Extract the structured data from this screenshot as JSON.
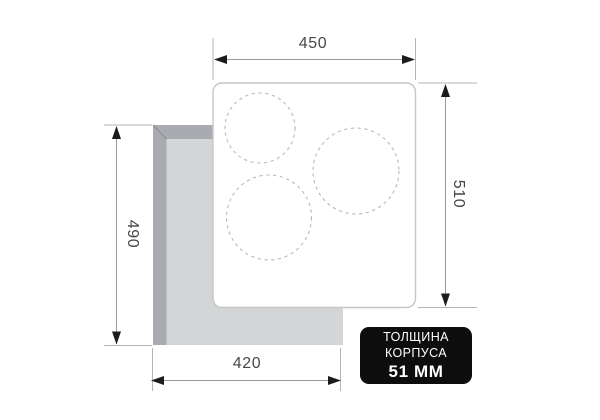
{
  "diagram": {
    "type": "hob-installation-cutout-drawing",
    "dims": {
      "top": "450",
      "right": "510",
      "left": "490",
      "bottom": "420"
    },
    "badge": {
      "line1": "ТОЛЩИНА",
      "line2": "КОРПУСА",
      "value": "51 ММ"
    },
    "cooking_zones_count": 3,
    "colors": {
      "counter_edge_dark": "#a8acb0",
      "counter_surface": "#d3d5d7",
      "panel_fill": "#ffffff",
      "panel_border": "#c5c6c8",
      "zone_dash": "#b6b8ba",
      "extension_line": "#b5b5b5",
      "dimension_line": "#9a9a9a",
      "arrow": "#1c1c1c",
      "label_text": "#474747",
      "badge_bg": "#0d0d0e",
      "badge_text": "#ffffff"
    }
  }
}
